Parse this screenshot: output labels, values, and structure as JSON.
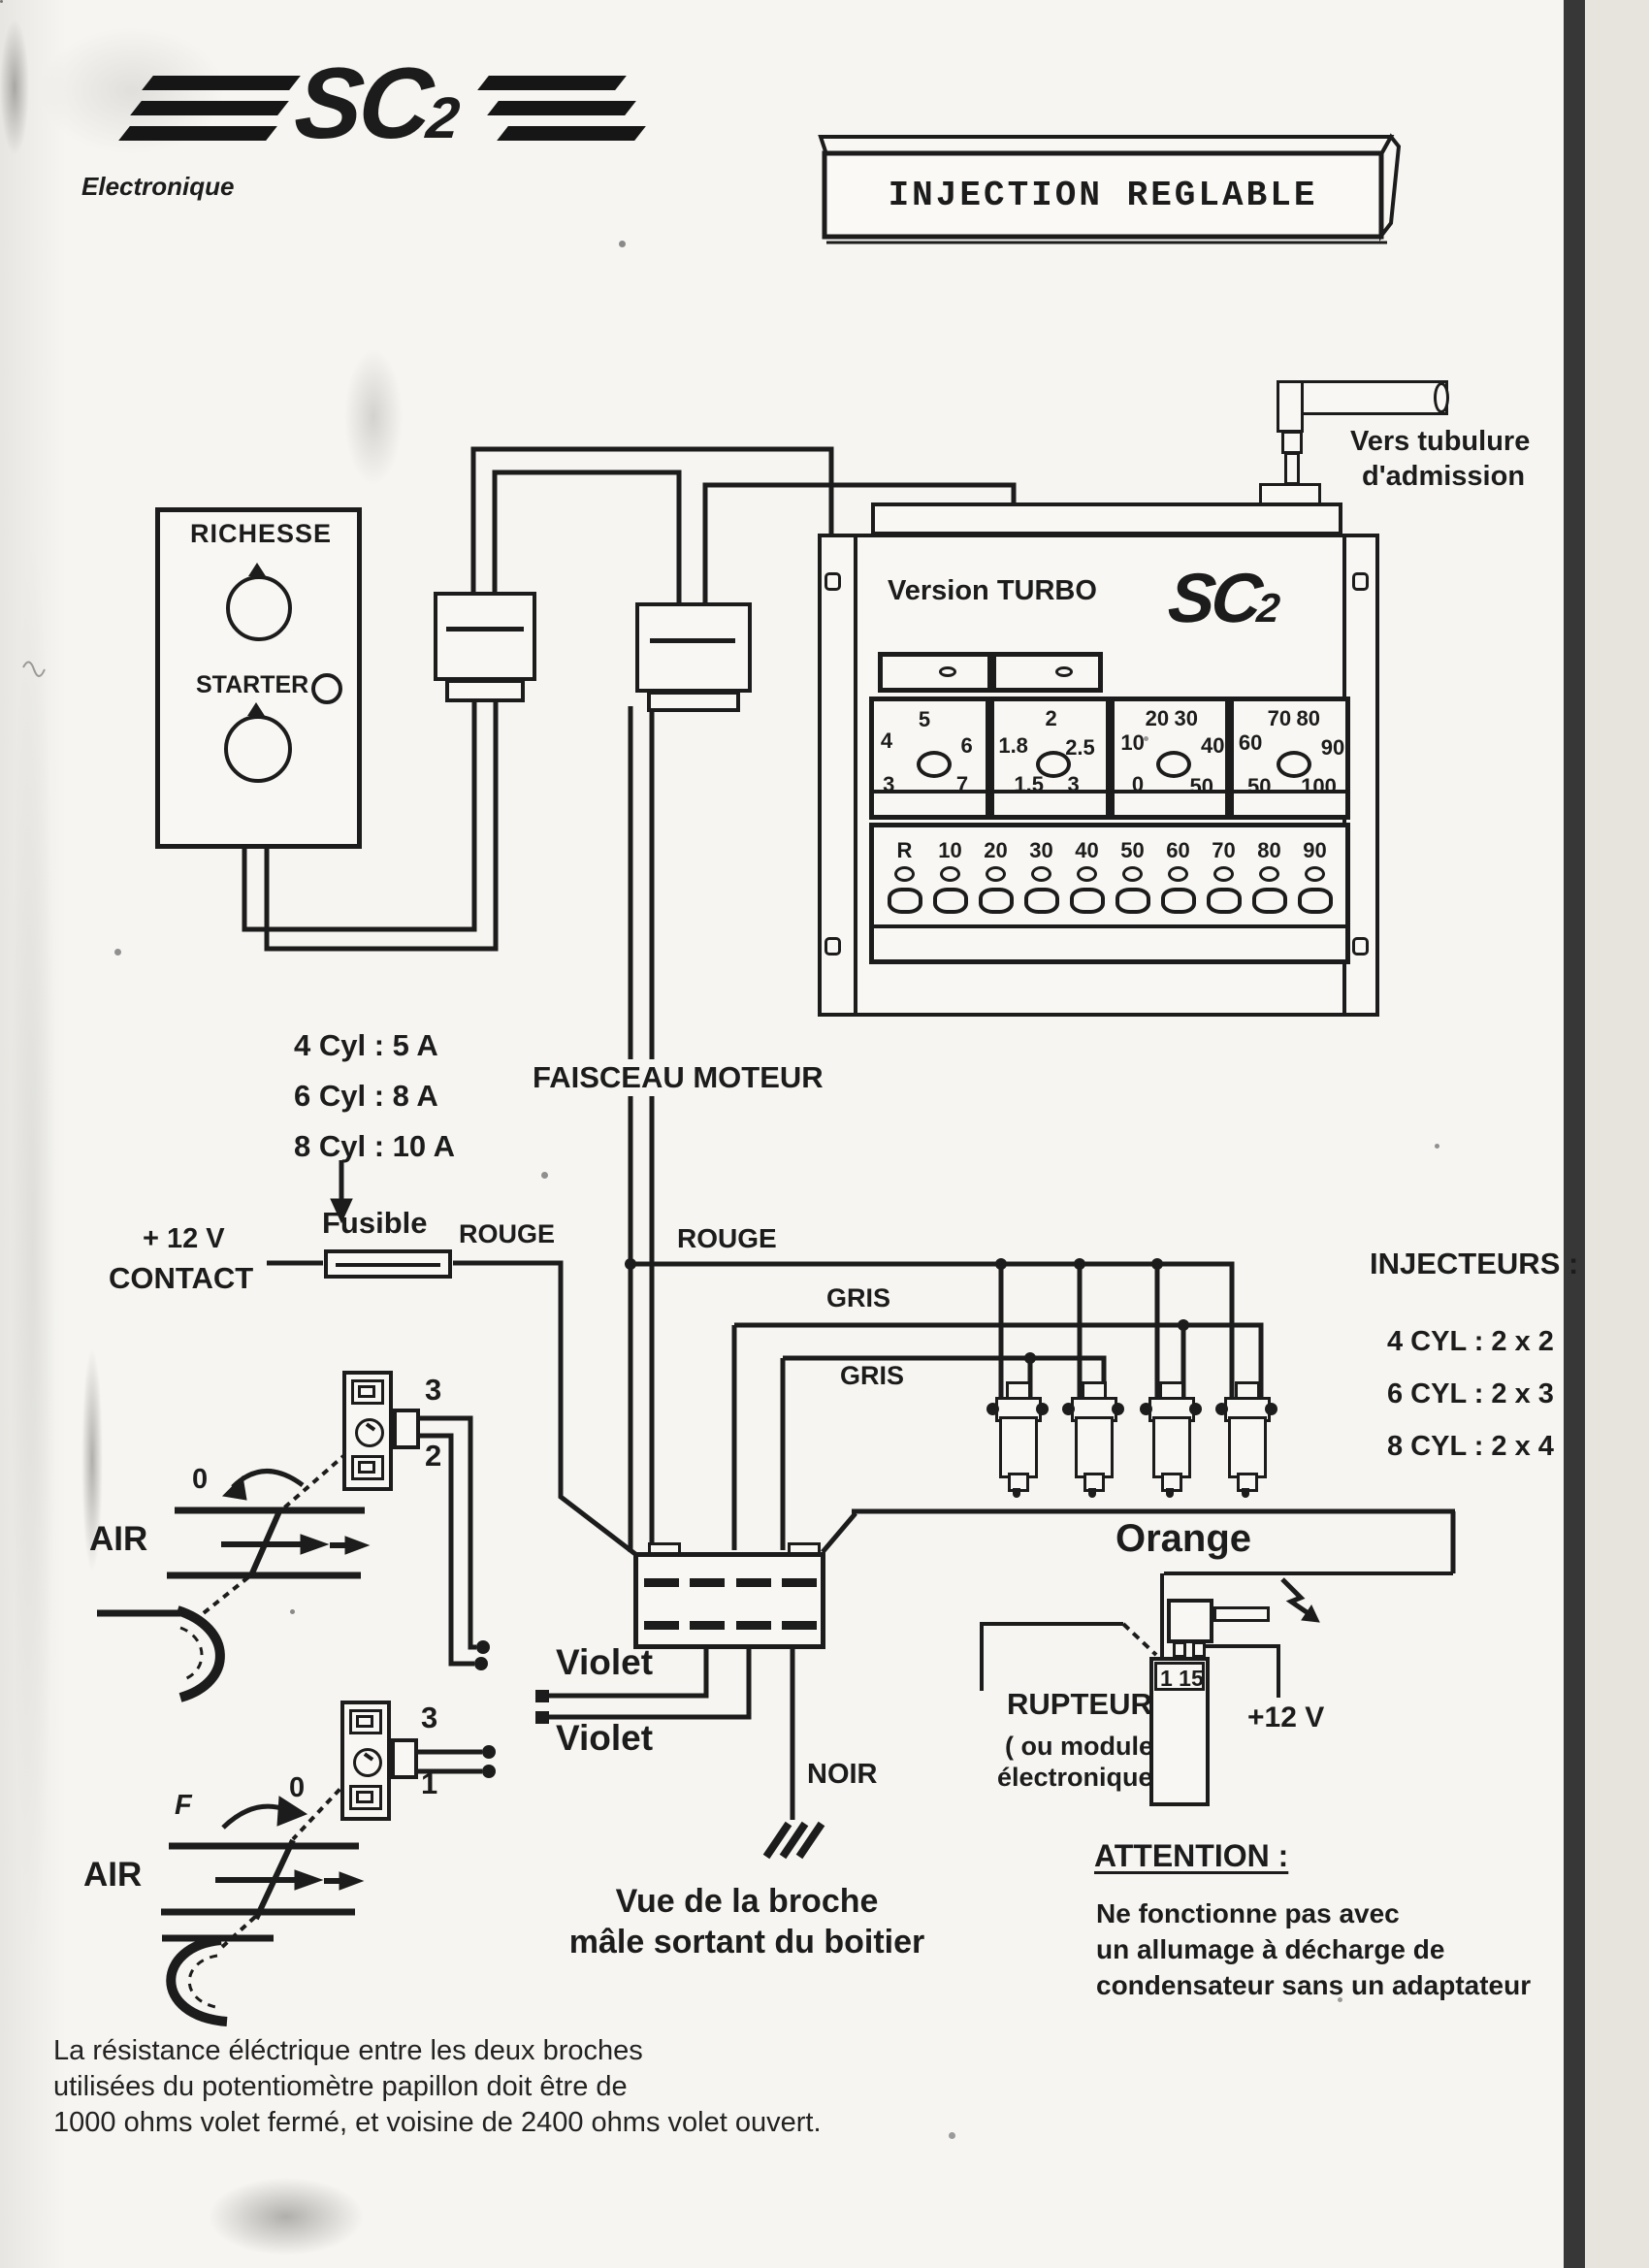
{
  "logo": {
    "brand": "SC",
    "brand_sub": "2",
    "tagline": "Electronique"
  },
  "title": "INJECTION REGLABLE",
  "admission_label": {
    "line1": "Vers tubulure",
    "line2": "d'admission"
  },
  "richesse_panel": {
    "title": "RICHESSE",
    "starter": "STARTER"
  },
  "unit": {
    "version": "Version TURBO",
    "brand": "SC",
    "brand_sub": "2",
    "dials": [
      {
        "numbers": [
          {
            "t": "4",
            "x": 6,
            "y": 24
          },
          {
            "t": "5",
            "x": 40,
            "y": 5
          },
          {
            "t": "6",
            "x": 78,
            "y": 28
          },
          {
            "t": "3",
            "x": 8,
            "y": 62
          },
          {
            "t": "7",
            "x": 74,
            "y": 62
          }
        ]
      },
      {
        "numbers": [
          {
            "t": "1.8",
            "x": 4,
            "y": 28
          },
          {
            "t": "2",
            "x": 46,
            "y": 4
          },
          {
            "t": "2.5",
            "x": 64,
            "y": 30
          },
          {
            "t": "1.5",
            "x": 18,
            "y": 62
          },
          {
            "t": "3",
            "x": 66,
            "y": 62
          }
        ]
      },
      {
        "numbers": [
          {
            "t": "10",
            "x": 6,
            "y": 26
          },
          {
            "t": "20",
            "x": 28,
            "y": 4
          },
          {
            "t": "30",
            "x": 54,
            "y": 4
          },
          {
            "t": "40",
            "x": 78,
            "y": 28
          },
          {
            "t": "0",
            "x": 16,
            "y": 62
          },
          {
            "t": "50",
            "x": 68,
            "y": 64
          }
        ]
      },
      {
        "numbers": [
          {
            "t": "60",
            "x": 4,
            "y": 26
          },
          {
            "t": "70",
            "x": 30,
            "y": 4
          },
          {
            "t": "80",
            "x": 56,
            "y": 4
          },
          {
            "t": "90",
            "x": 78,
            "y": 30
          },
          {
            "t": "50",
            "x": 12,
            "y": 64
          },
          {
            "t": "100",
            "x": 60,
            "y": 64
          }
        ]
      }
    ],
    "led_labels": [
      "R",
      "10",
      "20",
      "30",
      "40",
      "50",
      "60",
      "70",
      "80",
      "90"
    ]
  },
  "faisceau": "FAISCEAU MOTEUR",
  "fuse": {
    "rating_lines": [
      "4 Cyl : 5 A",
      "6 Cyl : 8 A",
      "8 Cyl : 10 A"
    ],
    "label": "Fusible",
    "supply_line1": "+ 12 V",
    "supply_line2": "CONTACT"
  },
  "wire_labels": {
    "rouge1": "ROUGE",
    "rouge2": "ROUGE",
    "gris1": "GRIS",
    "gris2": "GRIS",
    "orange": "Orange",
    "violet1": "Violet",
    "violet2": "Violet",
    "noir": "NOIR"
  },
  "injectors": {
    "title": "INJECTEURS :",
    "rows": [
      "4 CYL : 2 x 2",
      "6 CYL : 2 x 3",
      "8 CYL : 2 x 4"
    ]
  },
  "throttle1": {
    "air": "AIR",
    "pin_top": "3",
    "pin_bottom": "2",
    "zero": "0"
  },
  "throttle2": {
    "air": "AIR",
    "pin_top": "3",
    "pin_bottom": "1",
    "zero": "0",
    "mark": "F"
  },
  "connector_note": {
    "line1": "Vue de la broche",
    "line2": "mâle sortant du boitier"
  },
  "rupteur": {
    "line1": "RUPTEUR",
    "line2": "( ou module",
    "line3": "électronique)"
  },
  "coil": {
    "terminals": "1 15",
    "supply": "+12 V"
  },
  "attention": {
    "title": "ATTENTION :",
    "lines": [
      "Ne fonctionne pas avec",
      "un allumage à décharge de",
      "condensateur sans un adaptateur"
    ]
  },
  "footnote": [
    "La résistance éléctrique entre les deux broches",
    "utilisées du potentiomètre papillon doit être de",
    "1000 ohms volet fermé, et voisine de 2400 ohms volet ouvert."
  ],
  "ink_color": "#1c1c1c",
  "paper_color": "#f6f5f1"
}
